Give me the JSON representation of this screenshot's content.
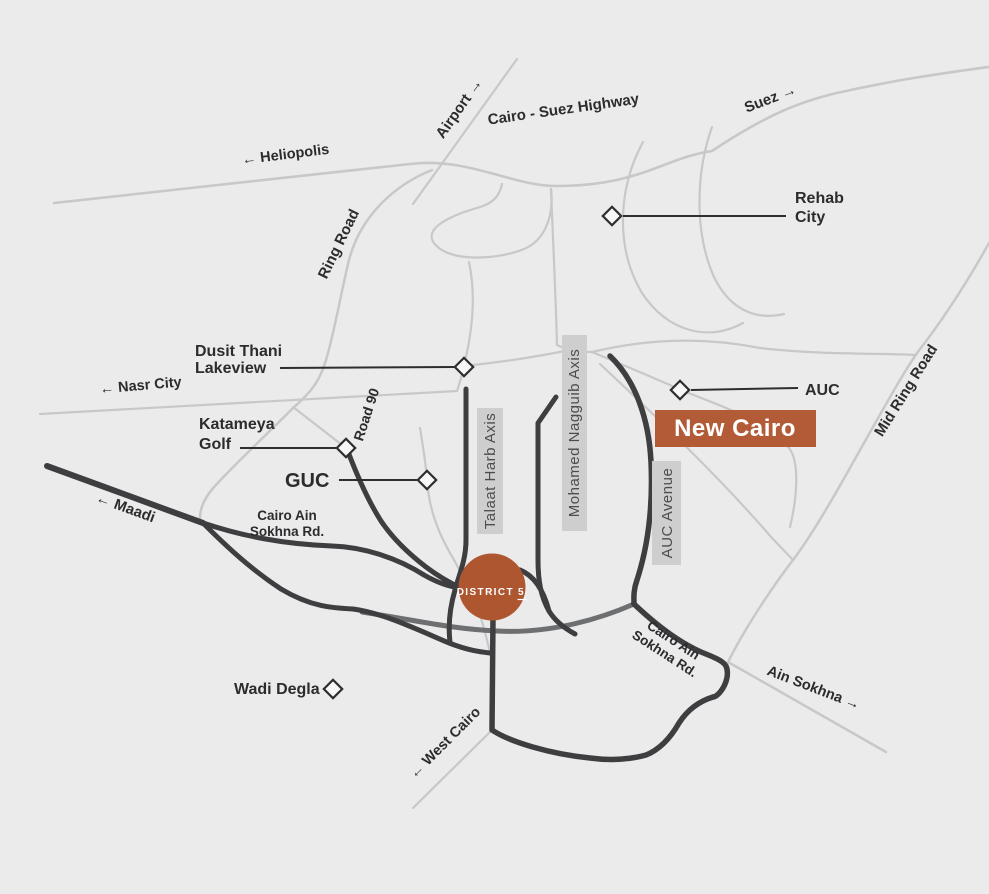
{
  "colors": {
    "background": "#ebebec",
    "road_light": "#c7c8c9",
    "road_medium": "#6d6f71",
    "road_dark": "#3e3e41",
    "label_box_bg": "#cecece",
    "label_box_text": "#4d4d4f",
    "label_text": "#2c2c2e",
    "accent_box": "#b25b36",
    "accent_circle": "#ad5630",
    "marker_fill": "#f7f7f7"
  },
  "road_labels": {
    "airport": "Airport →",
    "cairo_suez": "Cairo - Suez Highway",
    "suez": "Suez →",
    "heliopolis": "← Heliopolis",
    "ring_road": "Ring Road",
    "nasr_city": "← Nasr City",
    "road_90": "Road 90",
    "mid_ring_road": "Mid Ring Road",
    "maadi": "← Maadi",
    "west_cairo": "← West Cairo",
    "ain_sokhna": "Ain Sokhna →",
    "sokhna_left": {
      "line1": "Cairo Ain",
      "line2": "Sokhna Rd."
    },
    "sokhna_right": {
      "line1": "Cairo Ain",
      "line2": "Sokhna Rd."
    }
  },
  "axis_boxes": {
    "talaat": "Talaat Harb Axis",
    "nagguib": "Mohamed Nagguib Axis",
    "auc_avenue": "AUC Avenue"
  },
  "places": {
    "rehab": {
      "line1": "Rehab",
      "line2": "City"
    },
    "dusit": {
      "line1": "Dusit Thani",
      "line2": "Lakeview"
    },
    "katameya": {
      "line1": "Katameya",
      "line2": "Golf"
    },
    "guc": "GUC",
    "auc": "AUC",
    "wadi_degla": "Wadi Degla"
  },
  "highlights": {
    "new_cairo": "New Cairo",
    "district5": {
      "word": "DISTRICT",
      "number": "5"
    }
  }
}
